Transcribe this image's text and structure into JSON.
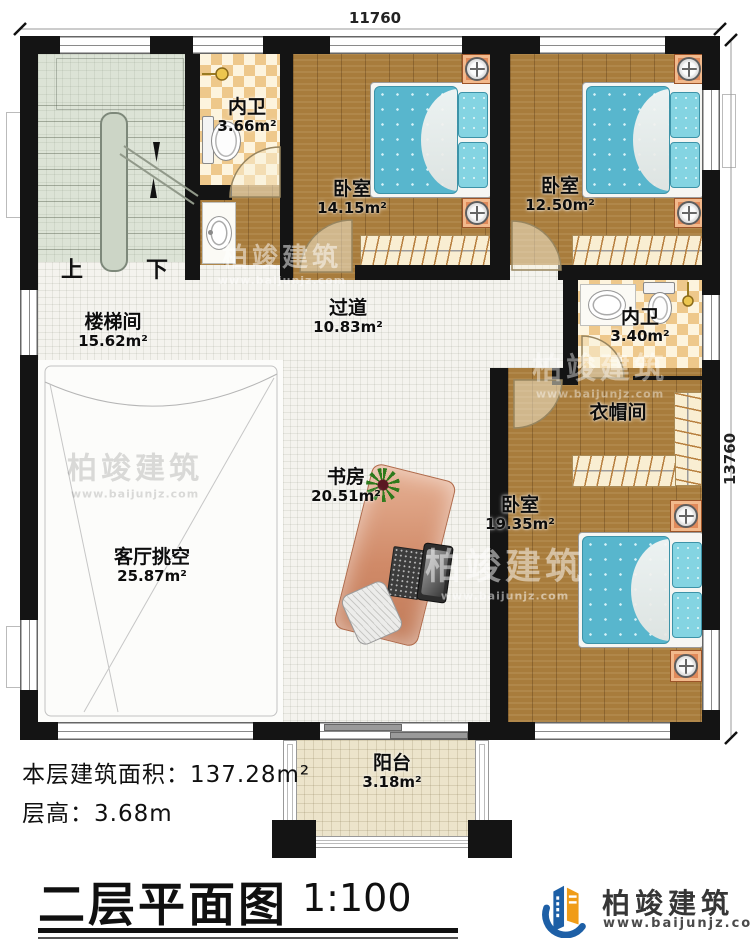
{
  "dimensions": {
    "top": "11760",
    "right": "13760"
  },
  "rooms": [
    {
      "name": "楼梯间",
      "area": "15.62m²"
    },
    {
      "name": "内卫",
      "area": "3.66m²"
    },
    {
      "name": "卧室",
      "area": "14.15m²"
    },
    {
      "name": "卧室",
      "area": "12.50m²"
    },
    {
      "name": "过道",
      "area": "10.83m²"
    },
    {
      "name": "内卫",
      "area": "3.40m²"
    },
    {
      "name": "衣帽间",
      "area": ""
    },
    {
      "name": "卧室",
      "area": "19.35m²"
    },
    {
      "name": "书房",
      "area": "20.51m²"
    },
    {
      "name": "客厅挑空",
      "area": "25.87m²"
    },
    {
      "name": "阳台",
      "area": "3.18m²"
    }
  ],
  "stairs": {
    "up": "上",
    "down": "下"
  },
  "annotations": {
    "area_label": "本层建筑面积：",
    "area_value": "137.28m²",
    "floor_height_label": "层高：",
    "floor_height_value": "3.68m"
  },
  "titleblock": {
    "title": "二层平面图",
    "scale": "1:100"
  },
  "brand": {
    "name": "柏竣建筑",
    "url": "www.baijunjz.com"
  },
  "watermark": {
    "name": "柏竣建筑",
    "url": "www.baijunjz.com"
  },
  "colors": {
    "wall": "#141414",
    "wood": "#a87c3c",
    "checker": "#eec88b",
    "tile": "#f4f3ee",
    "stair": "#dce3d6",
    "bed": "#58b6cd",
    "balcony": "#ece4cb",
    "brand_blue": "#1d5fa6",
    "brand_orange": "#f09c17"
  }
}
